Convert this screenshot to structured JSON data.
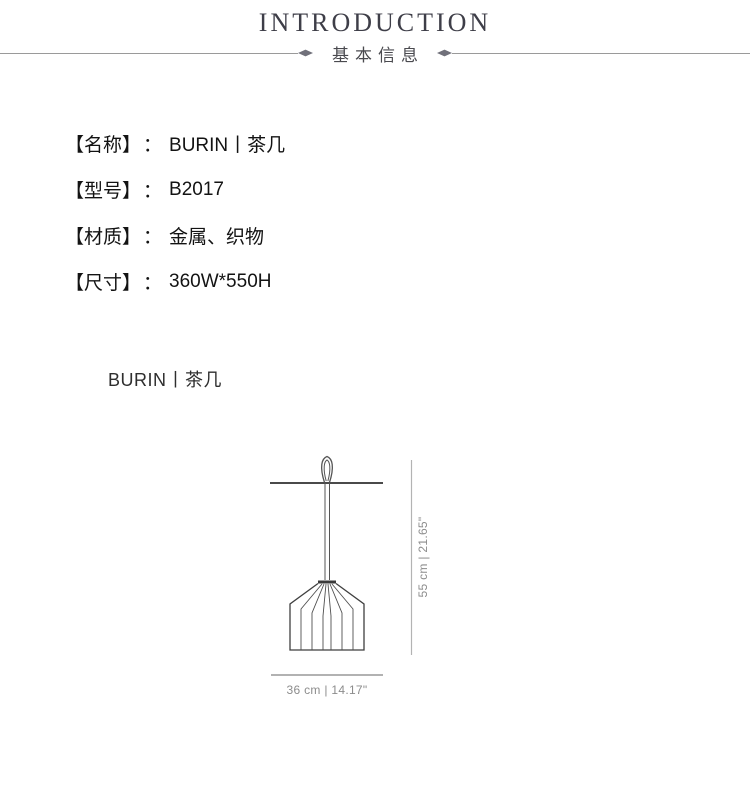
{
  "header": {
    "title": "INTRODUCTION",
    "subtitle": "基本信息"
  },
  "specs": {
    "colon": "：",
    "items": [
      {
        "label": "【名称】",
        "value": "BURIN丨茶几"
      },
      {
        "label": "【型号】",
        "value": "B2017"
      },
      {
        "label": "【材质】",
        "value": "金属、织物"
      },
      {
        "label": "【尺寸】",
        "value": "360W*550H"
      }
    ]
  },
  "product": {
    "title": "BURIN丨茶几"
  },
  "diagram": {
    "height_label": "55 cm | 21.65\"",
    "width_label": "36 cm | 14.17\""
  },
  "colors": {
    "ink": "#131313",
    "heading": "#3e3e48",
    "subtitle": "#4a4a4f",
    "divider_line": "#9a9a9a",
    "dimension_text": "#8c8c8c",
    "drawing_stroke": "#4a4a4a"
  }
}
